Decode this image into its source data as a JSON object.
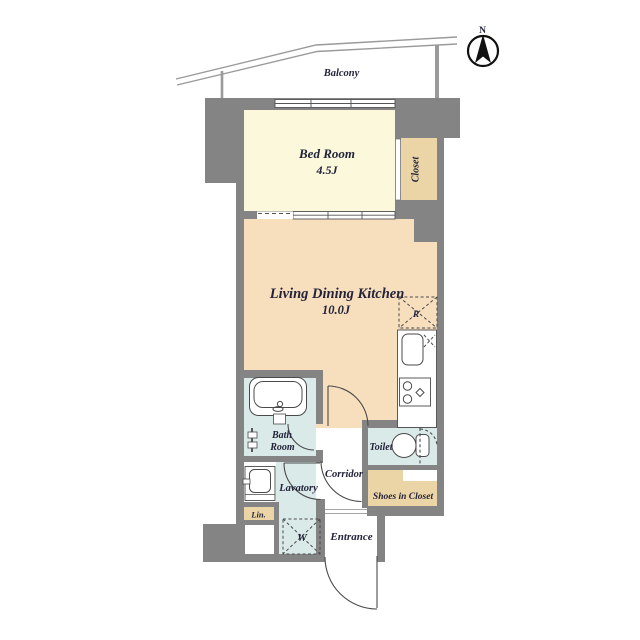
{
  "compass": {
    "label": "N"
  },
  "balcony": {
    "label": "Balcony"
  },
  "rooms": {
    "bedroom": {
      "name": "Bed Room",
      "size": "4.5J"
    },
    "living_dining_kitchen": {
      "name": "Living Dining Kitchen",
      "size": "10.0J"
    },
    "closet": {
      "name": "Closet"
    },
    "bath_room": {
      "line1": "Bath",
      "line2": "Room"
    },
    "toilet": {
      "name": "Toilet"
    },
    "corridor": {
      "name": "Corridor"
    },
    "lavatory": {
      "name": "Lavatory"
    },
    "shoes_in_closet": {
      "name": "Shoes in Closet"
    },
    "linen": {
      "name": "Lin."
    },
    "entrance": {
      "name": "Entrance"
    }
  },
  "fixtures": {
    "refrigerator": {
      "label": "R"
    },
    "washing_machine": {
      "label": "W"
    }
  },
  "colors": {
    "wall": "#848484",
    "bedroom_floor": "#FBF8DC",
    "ldk_floor": "#F7DFBE",
    "storage_tan": "#EBD4A6",
    "wet_area_blue": "#D9EAE9",
    "text": "#23233A",
    "railing": "#9A9A9A",
    "line": "#4A4A4A"
  }
}
